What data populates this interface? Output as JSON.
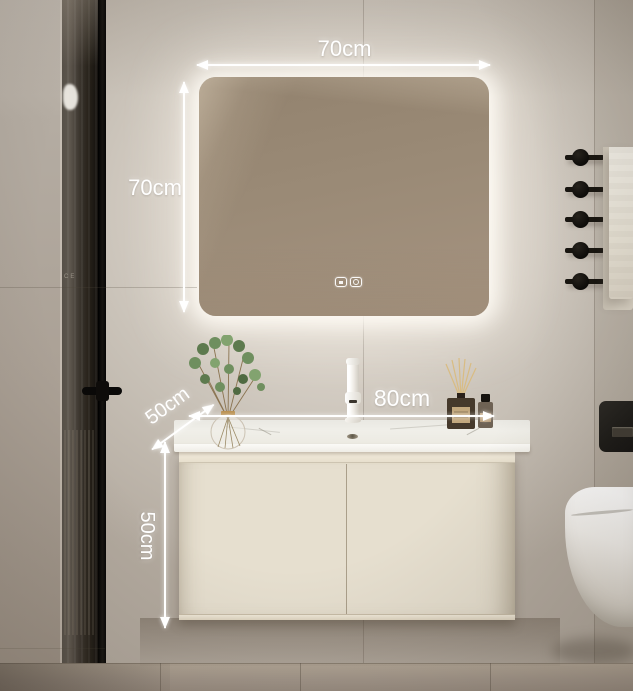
{
  "scene": {
    "type": "bathroom-vanity-product-photo",
    "glass_marking": "CE"
  },
  "annotations": {
    "mirror_width": {
      "label": "70cm"
    },
    "mirror_height": {
      "label": "70cm"
    },
    "vanity_width": {
      "label": "80cm"
    },
    "counter_depth": {
      "label": "50cm"
    },
    "cabinet_height": {
      "label": "50cm"
    }
  },
  "mirror": {
    "controls": [
      {
        "icon": "defog-button-icon"
      },
      {
        "icon": "power-button-icon"
      }
    ]
  },
  "colors": {
    "wall": "#d6cfc6",
    "left_wall": "#aba196",
    "mirror_glass": "#9a8a76",
    "mirror_glow": "#fffcf5",
    "cabinet": "#e6dfcf",
    "counter": "#f0efe9",
    "shower_glass": "#262119",
    "hardware_black": "#17140f",
    "towel": "#f2efe7",
    "annotation_text": "#ffffff",
    "floor": "#a2968a"
  }
}
